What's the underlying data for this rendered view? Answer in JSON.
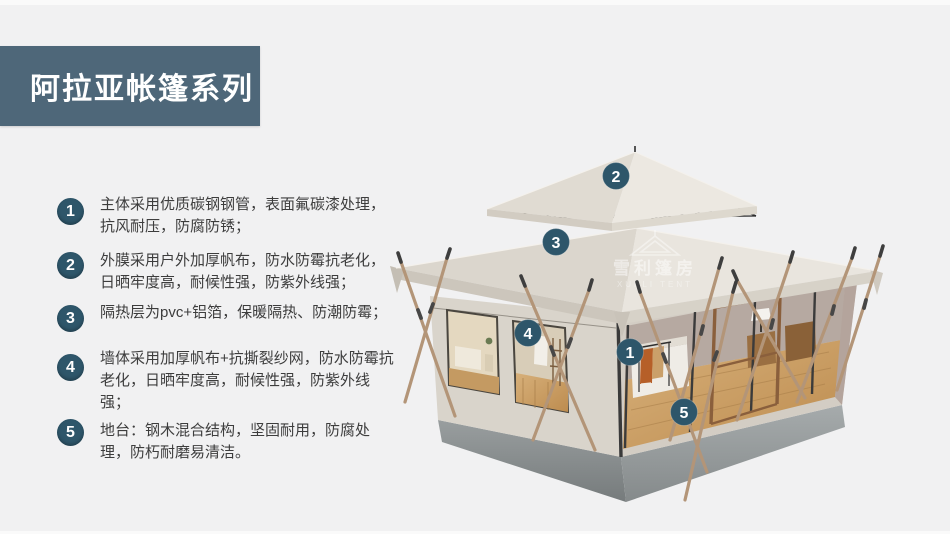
{
  "page": {
    "background": "#f1f1f2"
  },
  "header": {
    "title": "阿拉亚帐篷系列"
  },
  "features": [
    {
      "num": "1",
      "text": "主体采用优质碳钢钢管，表面氟碳漆处理，抗风耐压，防腐防锈；"
    },
    {
      "num": "2",
      "text": "外膜采用户外加厚帆布，防水防霉抗老化，日晒牢度高，耐候性强，防紫外线强；"
    },
    {
      "num": "3",
      "text": "隔热层为pvc+铝箔，保暖隔热、防潮防霉；"
    },
    {
      "num": "4",
      "text": "墙体采用加厚帆布+抗撕裂纱网，防水防霉抗老化，日晒牢度高，耐候性强，防紫外线强；"
    },
    {
      "num": "5",
      "text": "地台：钢木混合结构，坚固耐用，防腐处理，防朽耐磨易清洁。"
    }
  ],
  "markers": [
    {
      "label": "1"
    },
    {
      "label": "2"
    },
    {
      "label": "3"
    },
    {
      "label": "4"
    },
    {
      "label": "5"
    }
  ],
  "watermark": {
    "cn": "雪利篷房",
    "en": "XUELI TENT"
  },
  "colors": {
    "accent_banner": "#4e6779",
    "number_badge": "#2e566a",
    "marker_badge": "#2e566a",
    "body_text": "#3d3d3d",
    "roof_canvas": "#e9e5de",
    "platform_gray": "#8e9394",
    "pole_wood": "#b39578"
  }
}
